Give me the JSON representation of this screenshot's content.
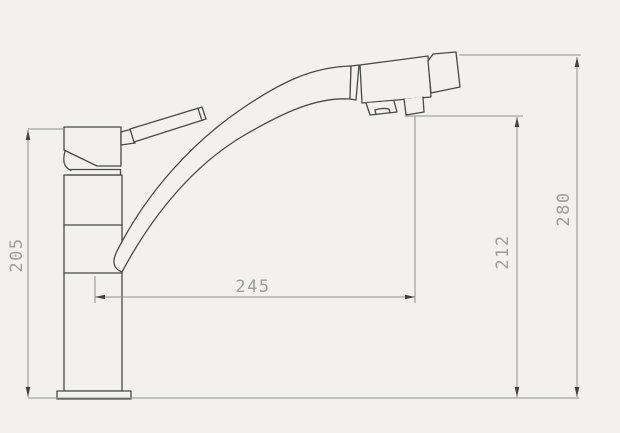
{
  "drawing": {
    "type": "technical-dimension-drawing",
    "subject": "kitchen-faucet-side-view",
    "background_color": "#f2f1ef",
    "outline_color": "#47494b",
    "dimension_line_color": "#8e9194",
    "label_color": "#9b9fa2",
    "dimensions": {
      "body_height": {
        "label": "205",
        "value": 205,
        "orientation": "vertical",
        "position": "left"
      },
      "spout_reach": {
        "label": "245",
        "value": 245,
        "orientation": "horizontal",
        "position": "middle"
      },
      "outlet_height": {
        "label": "212",
        "value": 212,
        "orientation": "vertical",
        "position": "right-inner"
      },
      "total_height": {
        "label": "280",
        "value": 280,
        "orientation": "vertical",
        "position": "right-outer"
      }
    }
  }
}
